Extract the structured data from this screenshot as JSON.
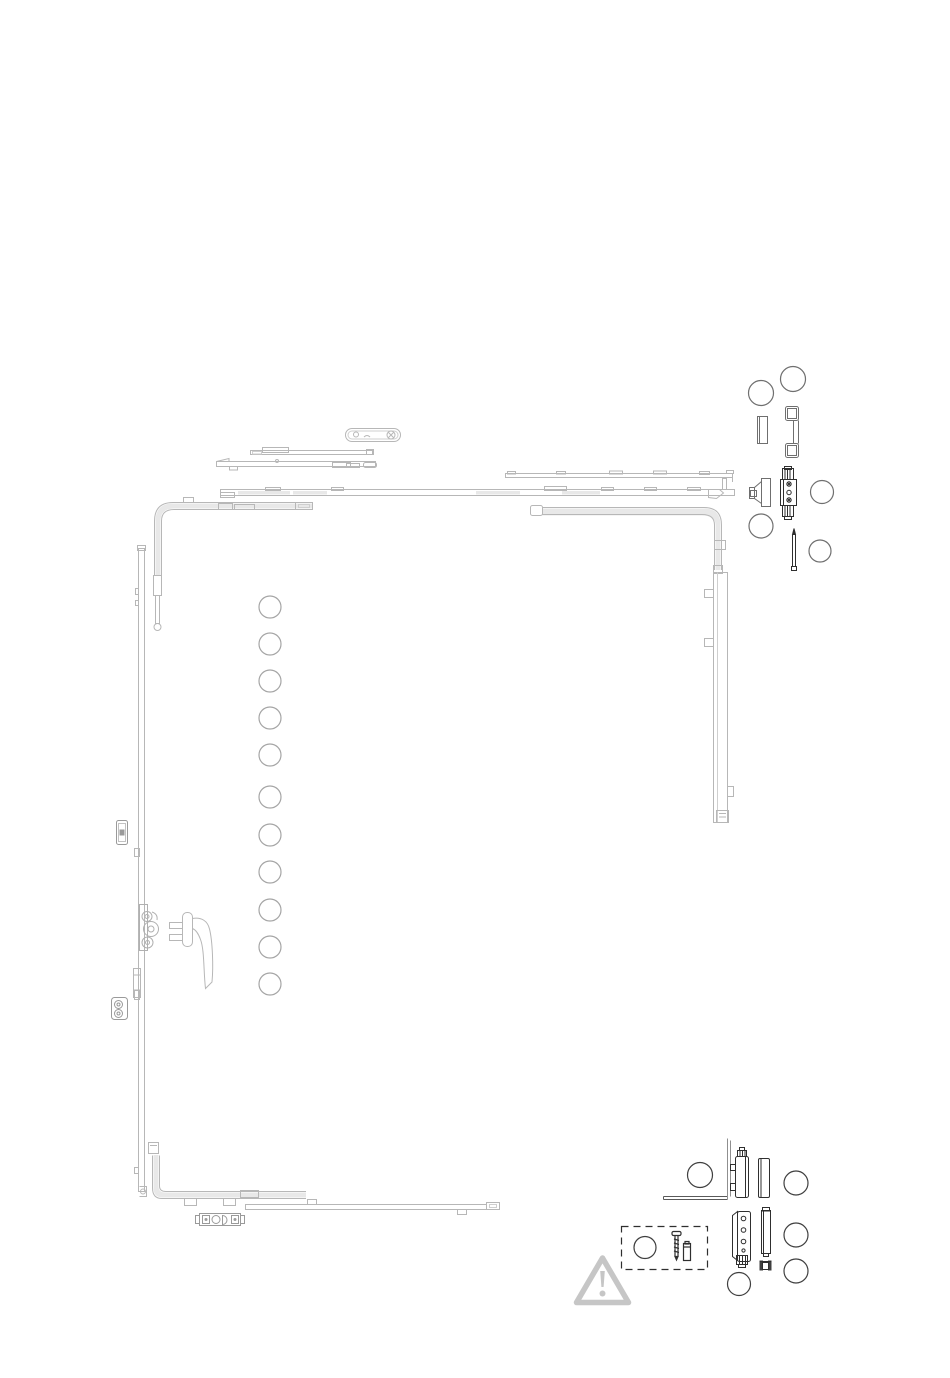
{
  "canvas": {
    "width": 950,
    "height": 1378,
    "background": "#ffffff"
  },
  "colors": {
    "line_light": "#b7b7b7",
    "line_medium": "#8f8f8f",
    "line_dark": "#2f2f2f",
    "band_fill": "#e8e8e8",
    "warning_gray": "#c6c6c6",
    "callout_light": "#a5a5a5",
    "callout_medium": "#6f6f6f",
    "callout_dark": "#3f3f3f"
  },
  "diagram": {
    "kind": "window-hardware-exploded-parts-diagram",
    "visible_text": "",
    "warning_symbol": "exclamation-triangle"
  },
  "callouts": {
    "left_column": {
      "count": 11,
      "labels": [
        "",
        "",
        "",
        "",
        "",
        "",
        "",
        "",
        "",
        "",
        ""
      ]
    },
    "top_right": {
      "count": 5,
      "labels": [
        "",
        "",
        "",
        "",
        ""
      ]
    },
    "bottom_right": {
      "count": 5,
      "labels": [
        "",
        "",
        "",
        "",
        ""
      ]
    },
    "accessory_box": {
      "count": 1,
      "labels": [
        ""
      ]
    }
  },
  "parts": {
    "top_edge": [
      "locking-plate",
      "stay-arm-upper",
      "stay-arm-lower",
      "tilt-lock-rail",
      "espagnolette-top-rail",
      "corner-drive-top-left",
      "corner-drive-top-right"
    ],
    "right_edge": [
      "stay-guide-rail-right"
    ],
    "left_edge": [
      "espagnolette-left-rail",
      "striker-keeper-upper",
      "gearbox",
      "striker-keeper-lower",
      "window-handle"
    ],
    "bottom_edge": [
      "corner-drive-bottom-left",
      "bottom-rail",
      "striker-plate-bottom"
    ],
    "loose_top_right": [
      "cover-cap-small",
      "u-bracket",
      "tilt-wedge",
      "striker-plate-with-screws",
      "connecting-pin"
    ],
    "loose_bottom_right": [
      "stay-arm-bearing",
      "hinge-body",
      "hinge-cover-cap",
      "corner-hinge",
      "corner-hinge-cover-cap",
      "bushing"
    ],
    "accessory_box": [
      "mounting-screw",
      "wall-plug"
    ]
  }
}
